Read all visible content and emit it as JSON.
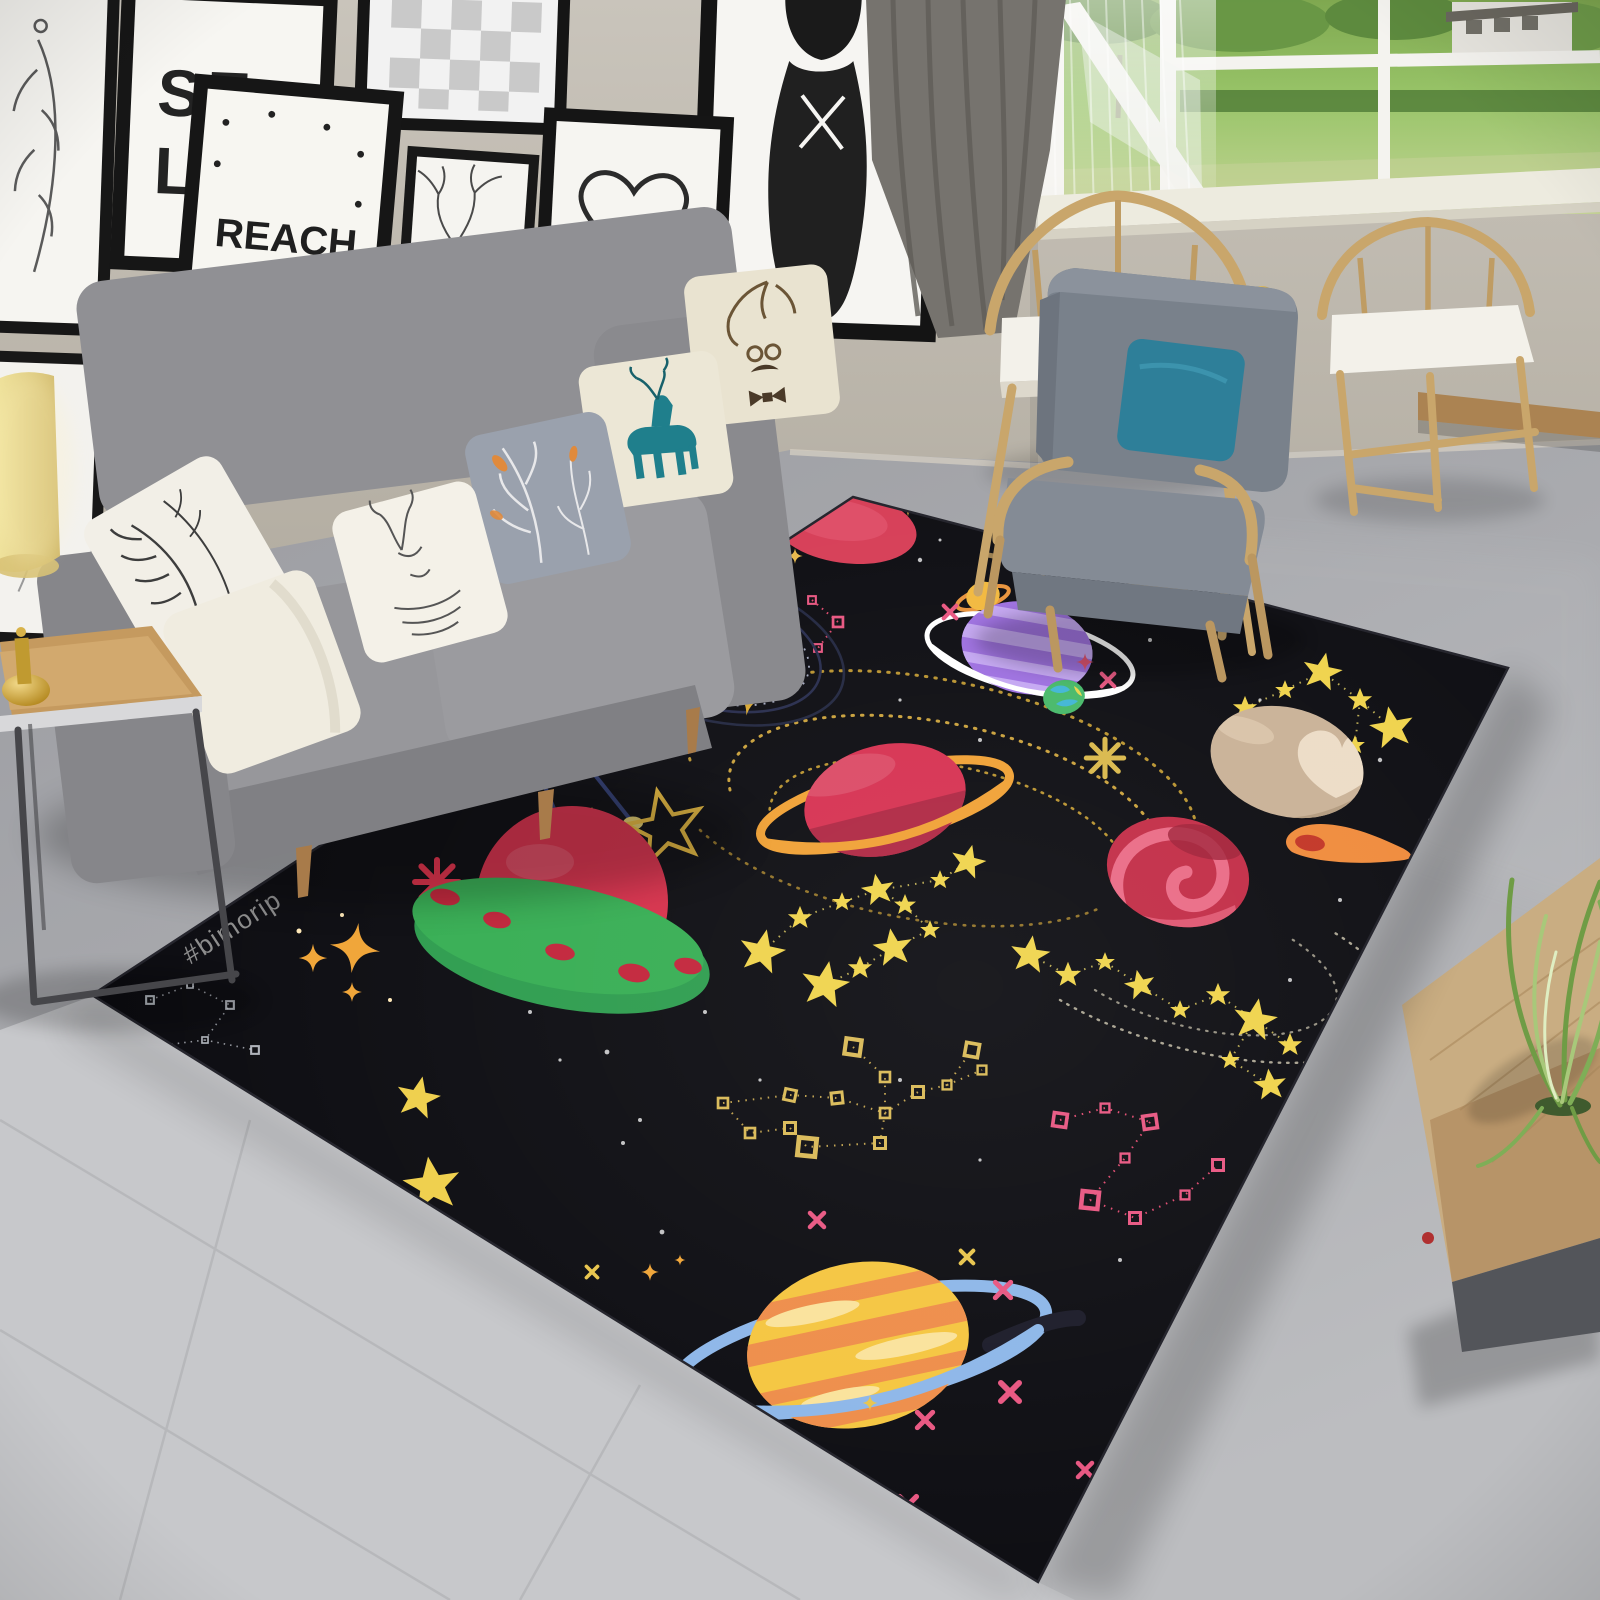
{
  "scene": {
    "type": "photograph",
    "description": "High-angle view of a living room with a black outer-space themed area rug with cartoon planets, a UFO, stars and constellations",
    "wall_color": "#bfb9af",
    "floor_color": "#a9aaae",
    "tile_color": "#c7c8cb",
    "ledge_color": "#ab8352"
  },
  "wall_gallery": {
    "frame_color": "#1b1b1b",
    "self_frame": {
      "line1": "SE",
      "line2": "LF"
    },
    "reach_frame": {
      "line1": "REACH",
      "line2": "FOR THE",
      "line3": "STARS."
    },
    "frames": [
      "feather sketch",
      "SELF typography",
      "checkerboard print",
      "woman portrait",
      "REACH FOR THE STARS print",
      "deer antler sketch",
      "heart dreamcatcher"
    ]
  },
  "window": {
    "frame_color": "#f4f3ef",
    "sill_color": "#edebdf",
    "curtain_color": "#76736e",
    "view": "sunlit green lawn, shrubs and a distant white house"
  },
  "furniture": {
    "sofa": {
      "fabric_color": "#919195",
      "leg_color": "#a87b4a",
      "pillows": [
        "white with black botanical print",
        "plain cream",
        "white with deer line sketch",
        "gray with white branches and orange leaves",
        "cream with teal deer",
        "cream with antlers and bow tie"
      ]
    },
    "armchair": {
      "fabric_color": "#7e858e",
      "pillow_color": "#2e7f99",
      "wood_color": "#c9a66b"
    },
    "wooden_chairs": {
      "count": 2,
      "wood_color": "#c9a66b",
      "cushion_color": "#f3f1ea"
    },
    "side_table": {
      "top_color": "#c59a5f",
      "frame_color": "#3c3c40"
    },
    "floor_lamp": {
      "shade_color": "#ead989",
      "base_color": "#c9a227"
    },
    "cabinet": {
      "wood_color": "#c9ad82",
      "base_color": "#53555a",
      "plant_color": "#7fae57"
    }
  },
  "rug": {
    "background_color": "#0b0b10",
    "watermark": "#bimorip",
    "star_colors": {
      "gold": "#efd34a",
      "orange": "#f0a435",
      "pink": "#e85580",
      "white": "#ffffff"
    },
    "constellations": [
      "gold squares figure",
      "pink squares figures",
      "yellow star chains",
      "navy lines with gold nodes",
      "faint white corner figure"
    ],
    "planets": [
      {
        "name": "red oval planet",
        "color": "#d63c55",
        "sparkle_color": "#e8b84a"
      },
      {
        "name": "coral planet with orbit rings",
        "color": "#e28379",
        "ring_color": "#2b3054",
        "spot_color": "#b85e58"
      },
      {
        "name": "mini saturn",
        "color": "#f2b83c",
        "ring_color": "#e8923a"
      },
      {
        "name": "purple striped planet",
        "color": "#9d6fe0",
        "stripe_color": "#c4a6f2",
        "ring_color": "#ffffff"
      },
      {
        "name": "mini earth",
        "color": "#45b868",
        "patch_color": "#3fb5d4"
      },
      {
        "name": "red saturn",
        "color": "#d63050",
        "ring_color": "#f0a033",
        "shade_color": "#a82440"
      },
      {
        "name": "tan planet with heart patch",
        "color": "#c9b196",
        "patch_color": "#ecdcc6"
      },
      {
        "name": "comet",
        "color": "#ef8a3a",
        "core_color": "#c23324"
      },
      {
        "name": "red swirl planet",
        "color": "#c22b45",
        "swirl_color": "#ea6a85"
      },
      {
        "name": "ufo",
        "saucer_color": "#35ad52",
        "dome_color": "#d62f4a",
        "spot_color": "#c22339"
      },
      {
        "name": "striped planet with blue ring",
        "color": "#f5c53e",
        "stripe_color": "#ee8c48",
        "ring_color": "#8cb6e8"
      }
    ]
  }
}
